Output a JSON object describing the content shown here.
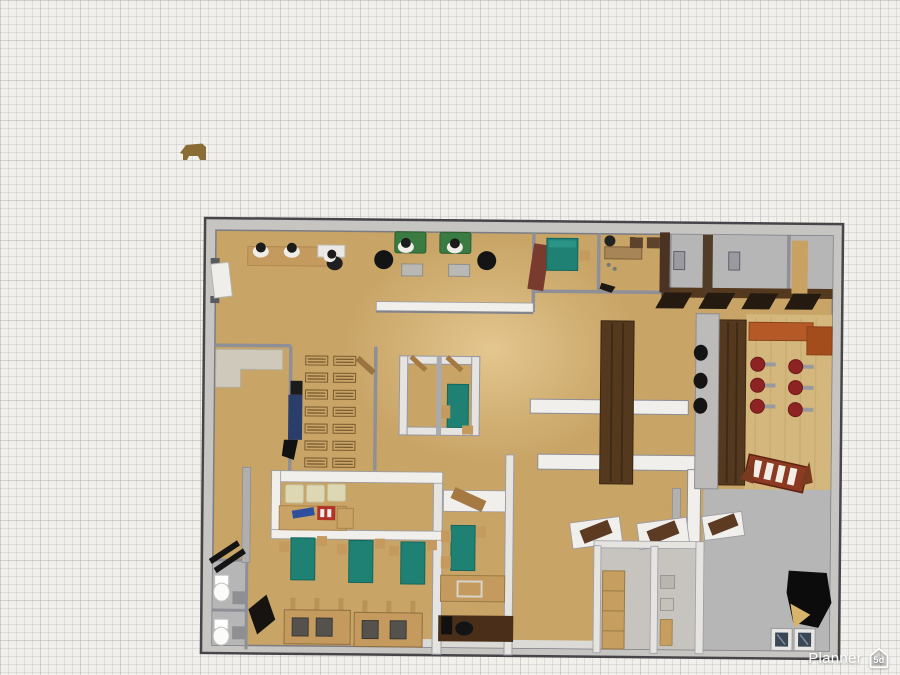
{
  "watermark": {
    "label": "Planner",
    "badge": "5d"
  },
  "colors": {
    "paper": "#f1f0ec",
    "wall_outline": "#46464a",
    "wall_face": "#c6c5c2",
    "wall_gray": "#8f8f97",
    "wall_white": "#f0efec",
    "wall_light": "#e6e4e0",
    "floor_tan": "#c8a466",
    "floor_tan_light": "#d4b77c",
    "floor_gray": "#b7b6b7",
    "floor_room_gray": "#c7c4bf",
    "floor_white": "#dcdad6",
    "dark_wood": "#54391f",
    "bench_dark": "#241a10",
    "wood": "#c49a5e",
    "wood_edge": "#8f6f3f",
    "door_brown": "#5d3a22",
    "door_red": "#7a3b2f",
    "door_tan": "#a57a42",
    "teal": "#1f8173",
    "teal_light": "#2a9486",
    "green_sofa": "#3a7b41",
    "beige": "#ddd7b4",
    "counter_beige": "#cfc9bb",
    "orange": "#b55a26",
    "orange_dark": "#a34d1d",
    "stool_red": "#8e2323",
    "rack_red": "#8c3a22",
    "black": "#141414",
    "blue": "#2e4f9e",
    "person_blue": "#2b3e6b",
    "truck_brown": "#8a6c35",
    "white": "#ffffff",
    "appliance_window": "#3a4754",
    "metal_gray": "#9a9a9e"
  }
}
